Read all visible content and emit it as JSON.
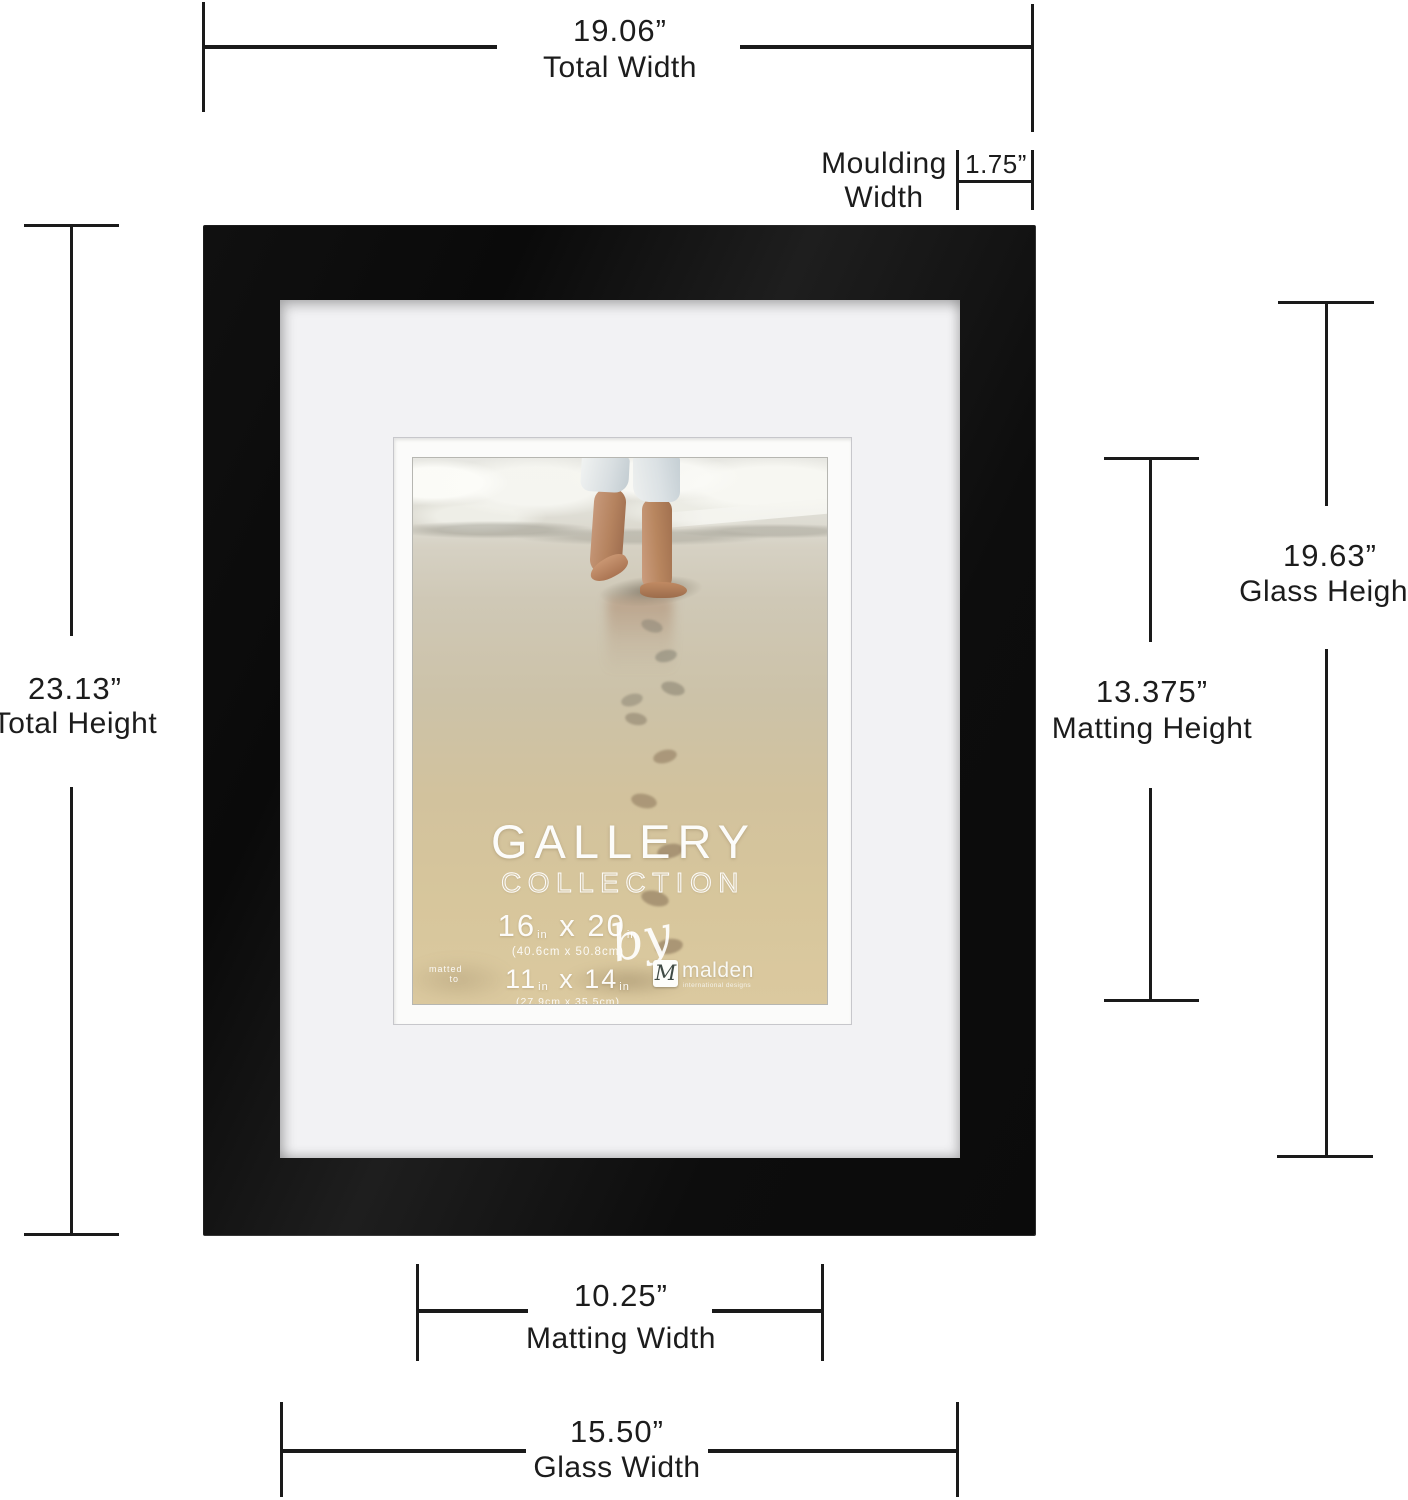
{
  "annotations": {
    "total_width": {
      "value": "19.06”",
      "label": "Total Width"
    },
    "moulding_width": {
      "value": "1.75”",
      "label1": "Moulding",
      "label2": "Width"
    },
    "total_height": {
      "value": "23.13”",
      "label": "Total Height"
    },
    "glass_height": {
      "value": "19.63”",
      "label": "Glass Height"
    },
    "matting_height": {
      "value": "13.375”",
      "label": "Matting Height"
    },
    "matting_width": {
      "value": "10.25”",
      "label": "Matting Width"
    },
    "glass_width": {
      "value": "15.50”",
      "label": "Glass Width"
    }
  },
  "frame_print": {
    "title": "GALLERY",
    "subtitle": "COLLECTION",
    "size1": {
      "w": "16",
      "sep": "x",
      "h": "20",
      "unit": "in",
      "metric": "(40.6cm x 50.8cm)"
    },
    "matted": {
      "prefix1": "matted",
      "prefix2": "to",
      "w": "11",
      "sep": "x",
      "h": "14",
      "unit": "in",
      "metric": "(27.9cm x 35.5cm)"
    },
    "by_label": "by",
    "brand": {
      "monogram": "M",
      "name": "malden",
      "tagline": "international designs"
    }
  },
  "colors": {
    "frame_black": "#111111",
    "mat_white": "#f2f2f4",
    "sand_gold": "#d5c49c",
    "dimension_line": "#1a1a1a",
    "background": "#ffffff"
  }
}
